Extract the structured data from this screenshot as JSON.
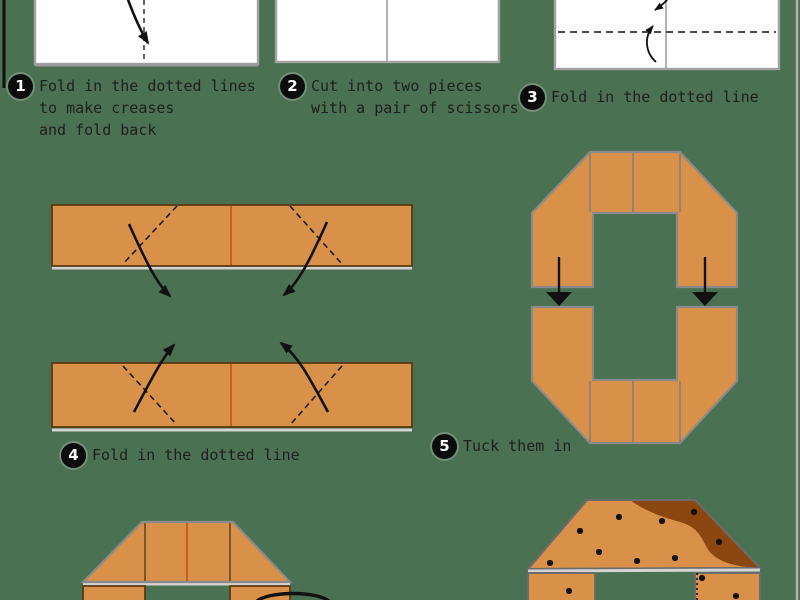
{
  "title": "Origami folding instructions",
  "colors": {
    "bg": "#4a7151",
    "orange": "#d99149",
    "crust": "#8c460f",
    "seam": "#c05f1f",
    "ink": "#1f1f1f"
  },
  "steps": [
    {
      "num": "1",
      "lines": [
        "Fold in the dotted lines",
        "to make creases",
        "and fold back"
      ]
    },
    {
      "num": "2",
      "lines": [
        "Cut into two pieces",
        "with a pair of scissors"
      ]
    },
    {
      "num": "3",
      "lines": [
        "Fold in the dotted line"
      ]
    },
    {
      "num": "4",
      "lines": [
        "Fold in the dotted line"
      ]
    },
    {
      "num": "5",
      "lines": [
        "Tuck them in"
      ]
    }
  ]
}
